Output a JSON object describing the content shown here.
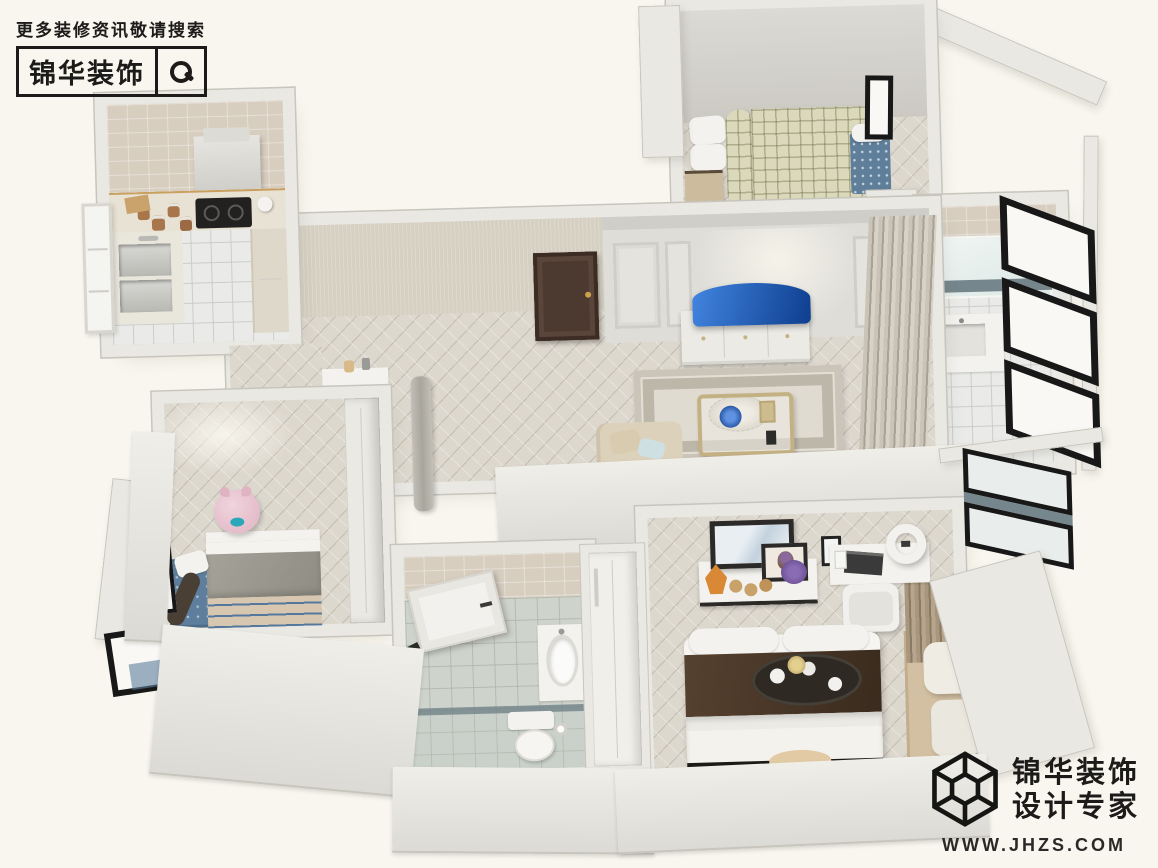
{
  "branding_top": {
    "search_hint": "更多装修资讯敬请搜索",
    "brand_name": "锦华装饰",
    "icon": "magnifier-icon"
  },
  "branding_bottom": {
    "brand_name": "锦华装饰",
    "tagline": "设计专家",
    "website": "WWW.JHZS.COM",
    "icon": "cube-wireframe-icon"
  },
  "palette": {
    "bg": "#f8f6ee",
    "wall": "#e9e8e3",
    "wall_edge": "#c8c5bd",
    "floor_wood": "#ddd8ce",
    "tile": "#eaebe8",
    "bath_tile": "#ced3cb",
    "wall_tile": "#d8cec0",
    "wallpaper": "#d6d0c2",
    "panel_wall": "#deddd8",
    "door_brown": "#4c3930",
    "tv_blue_light": "#4285e0",
    "tv_blue_dark": "#0e3e8e",
    "plaid": "#dbd9bc",
    "chaise_blue": "#5e7e9a",
    "rug_base": "#e0dbd1",
    "rug_border": "#b9b2a4",
    "gold": "#c4b183",
    "sofa": "#dcd1bb",
    "kids_rug": "#5d7f9d",
    "stripe_blue": "#54789d",
    "duvet_tan": "#d8c7b0",
    "blanket_grey": "#9d9b91",
    "pig_pink": "#eac9d5",
    "runner_brown": "#463526",
    "tan_rug": "#d3c0a3",
    "slate": "#75868c",
    "frame_black": "#181818",
    "ink": "#1c1b19"
  }
}
